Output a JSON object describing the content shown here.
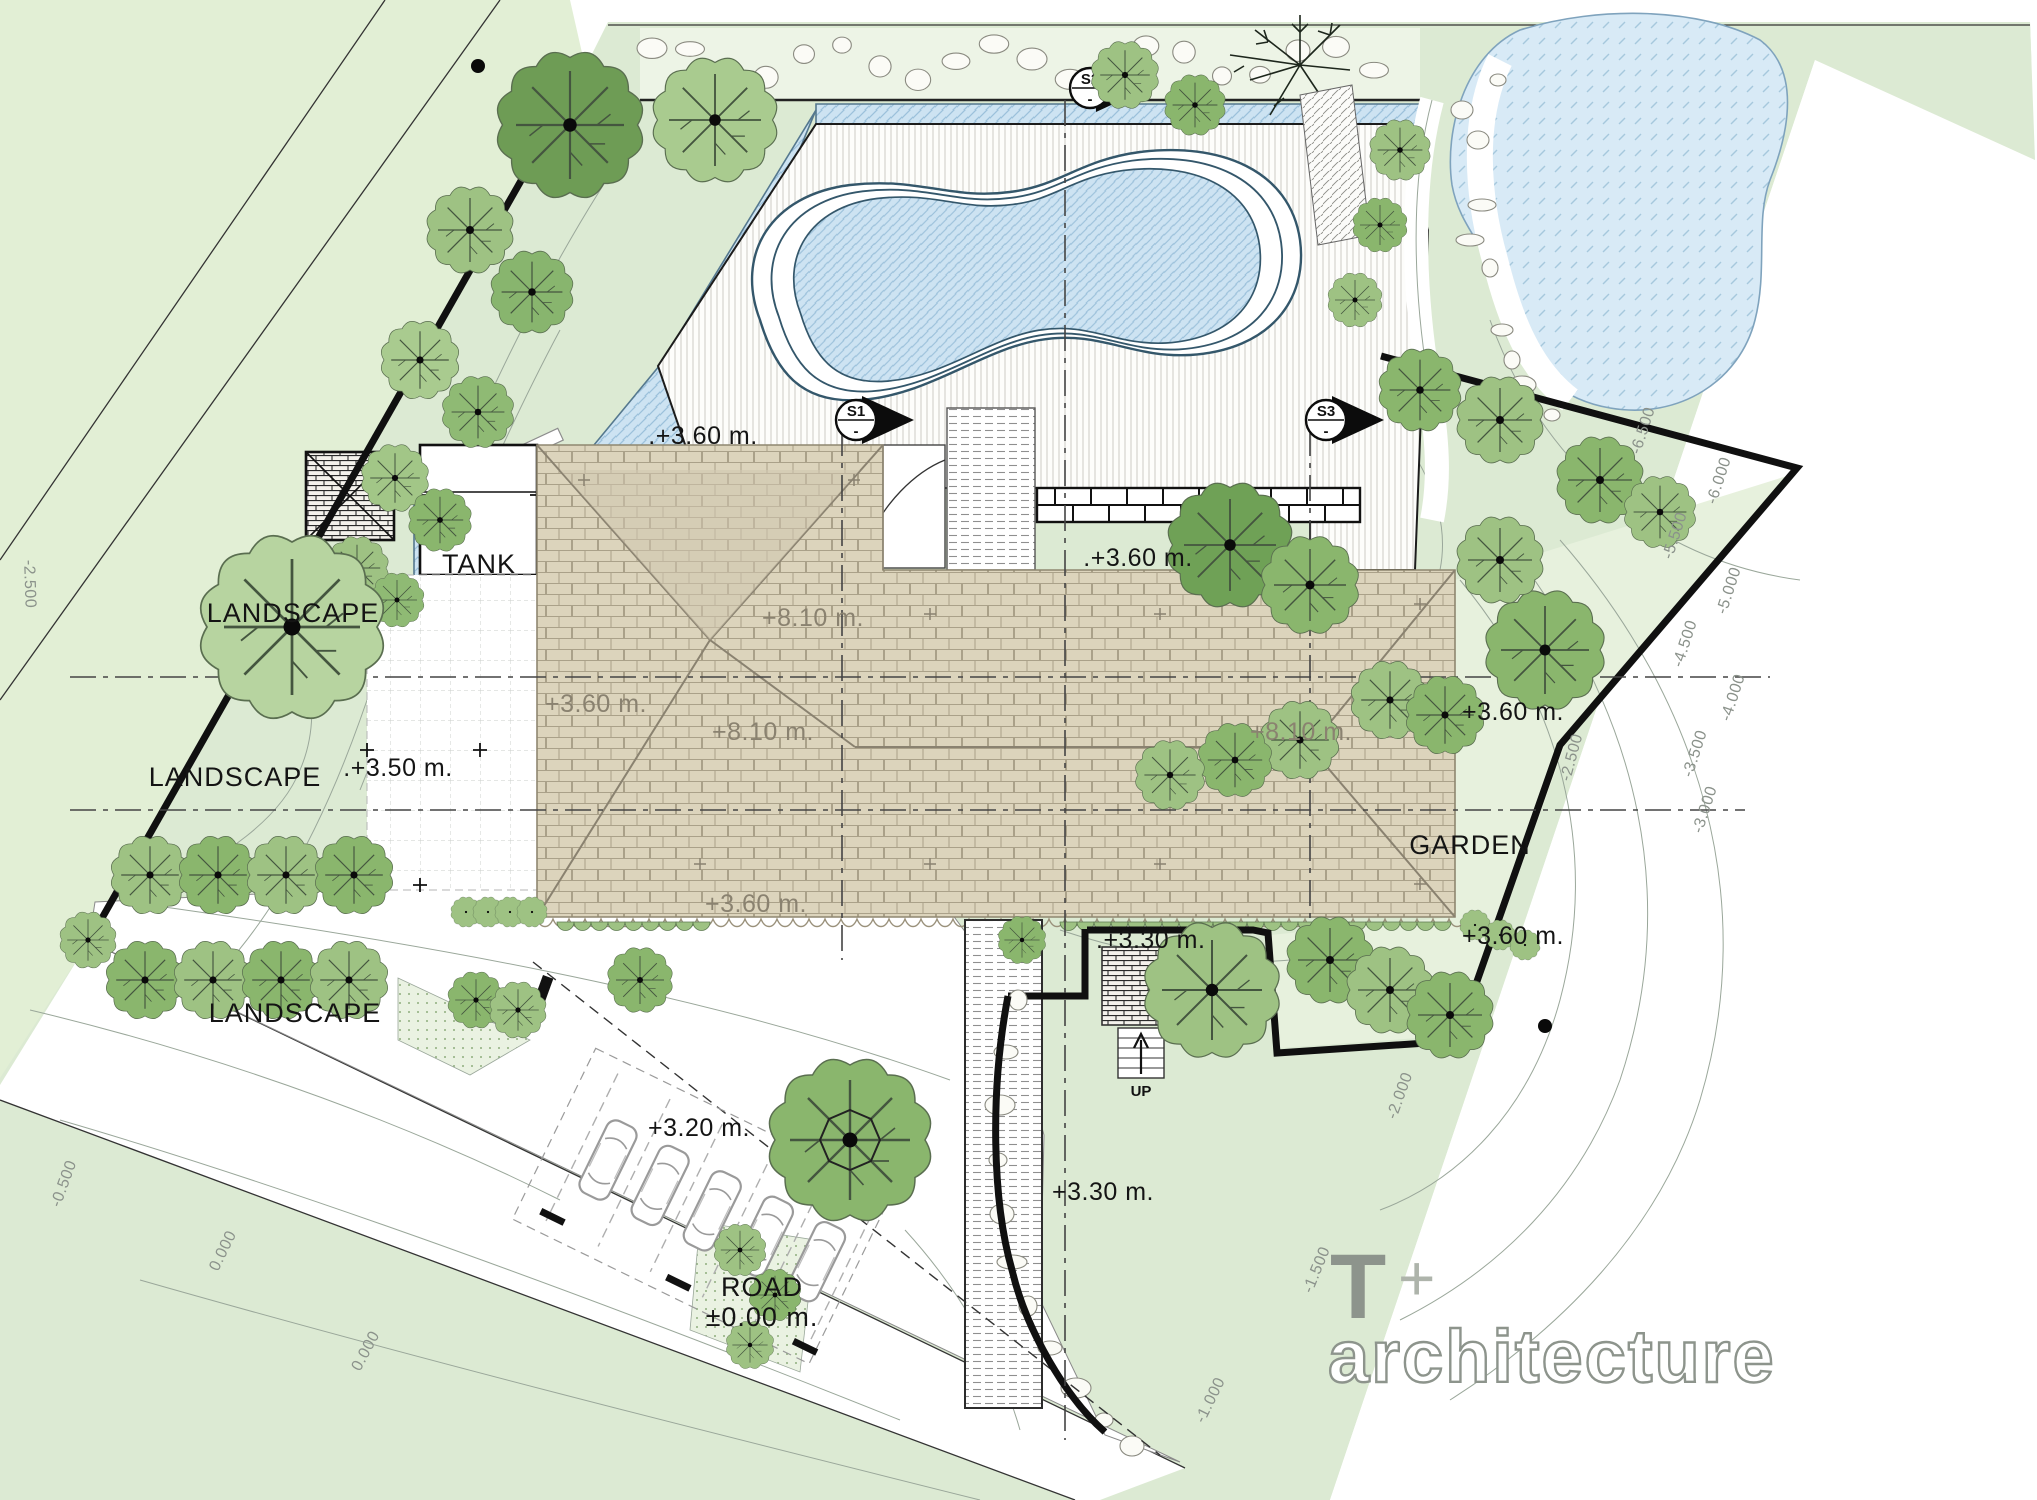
{
  "drawing": {
    "labels": {
      "landscape_upper": "LANDSCAPE",
      "landscape_mid": "LANDSCAPE",
      "landscape_lower": "LANDSCAPE",
      "tank": "TANK",
      "garden": "GARDEN",
      "up": "UP",
      "road_name": "ROAD",
      "road_level": "±0.00 m."
    },
    "elevations": {
      "deck_top": ".+3.60 m.",
      "garden_strip": ".+3.60 m.",
      "peak": "+8.10 m.",
      "ridge_left": "+8.10 m.",
      "ridge_right": "+8.10 m.",
      "roof_left": "+3.60 m.",
      "roof_bottom_left": "+3.60 m.",
      "garden_right": "+3.60 m.",
      "garden_bottom_right": "+3.60 m.",
      "courtyard": ".+3.50 m.",
      "parking": "+3.20 m.",
      "terrace": ".+3.30 m.",
      "walkway": "+3.30 m."
    },
    "sections": {
      "s1": "S1",
      "s2": "S2",
      "s3": "S3"
    },
    "contours": {
      "right": [
        "-6.500",
        "-6.000",
        "-5.500",
        "-5.000",
        "-4.500",
        "-4.000",
        "-3.500",
        "-3.000"
      ],
      "southeast": [
        "-2.500",
        "-2.000",
        "-1.500",
        "-1.000"
      ],
      "left": [
        "-2.500"
      ],
      "road": [
        "-0.500",
        "0.000",
        "0.000"
      ]
    },
    "logo": {
      "t": "T",
      "plus": "+",
      "word": "architecture"
    },
    "palette": {
      "site_green": "#dcead3",
      "parcel_green": "#e2efd5",
      "garden_green": "#e7f1dd",
      "water": "#cde3f2",
      "lake": "#d8eaf6",
      "water_line": "#9cc1db",
      "roof": "#dcd4bc",
      "roof_line": "#aaa189",
      "ink": "#141414",
      "gray": "#8b928b",
      "logo_gray": "#8d948c",
      "tree_dark": "#6e9c55",
      "tree_mid": "#8ab66d",
      "tree_light": "#a9cb8f"
    }
  }
}
